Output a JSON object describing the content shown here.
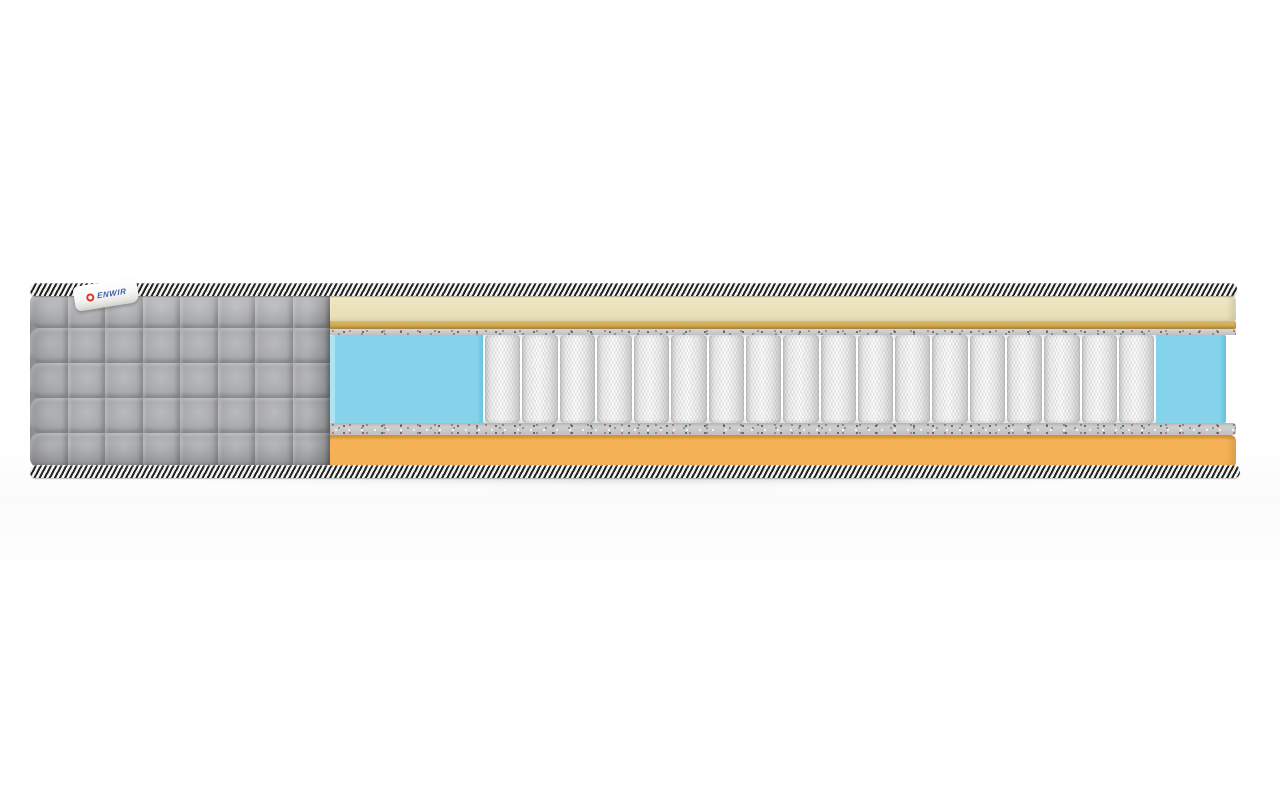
{
  "product": {
    "brand_label": "ENWIR"
  },
  "mattress": {
    "quilt": {
      "rows": 5,
      "cols": 8
    },
    "springs": {
      "count": 18
    },
    "colors": {
      "quilt_gray_light": "#b9babc",
      "quilt_gray": "#a8a9ab",
      "quilt_gray_dark": "#929396",
      "tape_dark": "#222222",
      "tape_light": "#f2f2ef",
      "cream_top": "#f0e8c6",
      "cream_bottom": "#e6ddb2",
      "gold_top": "#dcb766",
      "gold_bottom": "#c8a148",
      "felt_base": "#c0c0c0",
      "foam_blue": "#85d3ea",
      "foam_blue_highlight": "#ace4f3",
      "foam_blue_shade": "#64c3de",
      "spring_light": "#ffffff",
      "spring_shade": "#c7c8c9",
      "base_orange": "#f4b155",
      "base_orange_dark": "#dd9a3a",
      "label_red": "#d6382e",
      "label_blue": "#3f5ca8"
    }
  }
}
